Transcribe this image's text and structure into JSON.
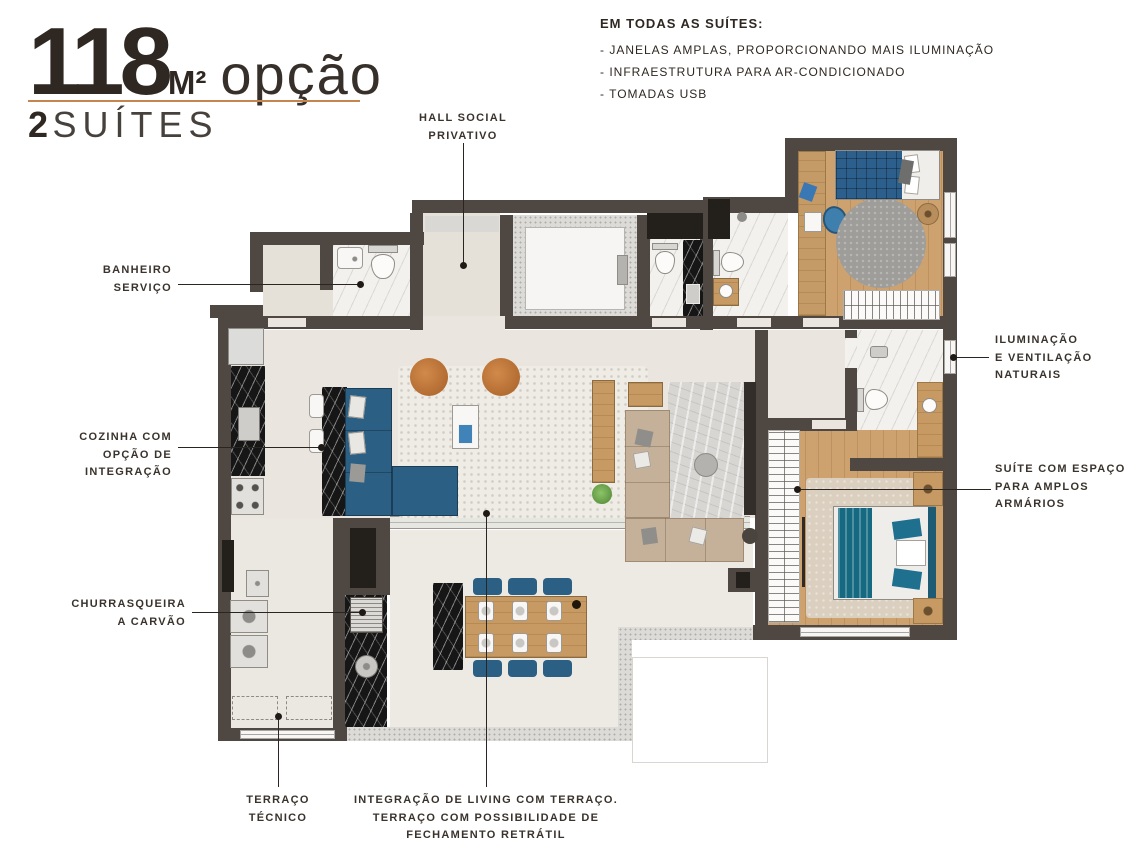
{
  "title": {
    "area_number": "118",
    "area_unit": "M²",
    "area_suffix": "opção",
    "subtitle_number": "2",
    "subtitle_text": "SUÍTES"
  },
  "features": {
    "heading": "EM TODAS AS SUÍTES:",
    "items": [
      "- JANELAS AMPLAS, PROPORCIONANDO MAIS ILUMINAÇÃO",
      "- INFRAESTRUTURA PARA AR-CONDICIONADO",
      "- TOMADAS USB"
    ]
  },
  "callouts": {
    "hall": {
      "lines": [
        "HALL SOCIAL",
        "PRIVATIVO"
      ]
    },
    "banheiro_servico": {
      "lines": [
        "BANHEIRO",
        "SERVIÇO"
      ]
    },
    "iluminacao": {
      "lines": [
        "ILUMINAÇÃO",
        "E VENTILAÇÃO",
        "NATURAIS"
      ]
    },
    "cozinha": {
      "lines": [
        "COZINHA COM",
        "OPÇÃO DE",
        "INTEGRAÇÃO"
      ]
    },
    "suite_armarios": {
      "lines": [
        "SUÍTE COM ESPAÇO",
        "PARA AMPLOS",
        "ARMÁRIOS"
      ]
    },
    "churrasqueira": {
      "lines": [
        "CHURRASQUEIRA",
        "A CARVÃO"
      ]
    },
    "terraco_tecnico": {
      "lines": [
        "TERRAÇO",
        "TÉCNICO"
      ]
    },
    "integracao": {
      "lines": [
        "INTEGRAÇÃO DE LIVING COM TERRAÇO.",
        "TERRAÇO COM POSSIBILIDADE DE",
        "FECHAMENTO RETRÁTIL"
      ]
    }
  },
  "colors": {
    "wall": "#4f4842",
    "floor_cream": "#eae6df",
    "wood": "#cda26f",
    "marble": "#f3f1ee",
    "black_marble": "#161616",
    "sofa_blue": "#2c5f84",
    "bed_teal": "#156a82",
    "pouf_orange": "#c0763a",
    "title_accent": "#c4854f",
    "text_dark": "#2f2721"
  }
}
